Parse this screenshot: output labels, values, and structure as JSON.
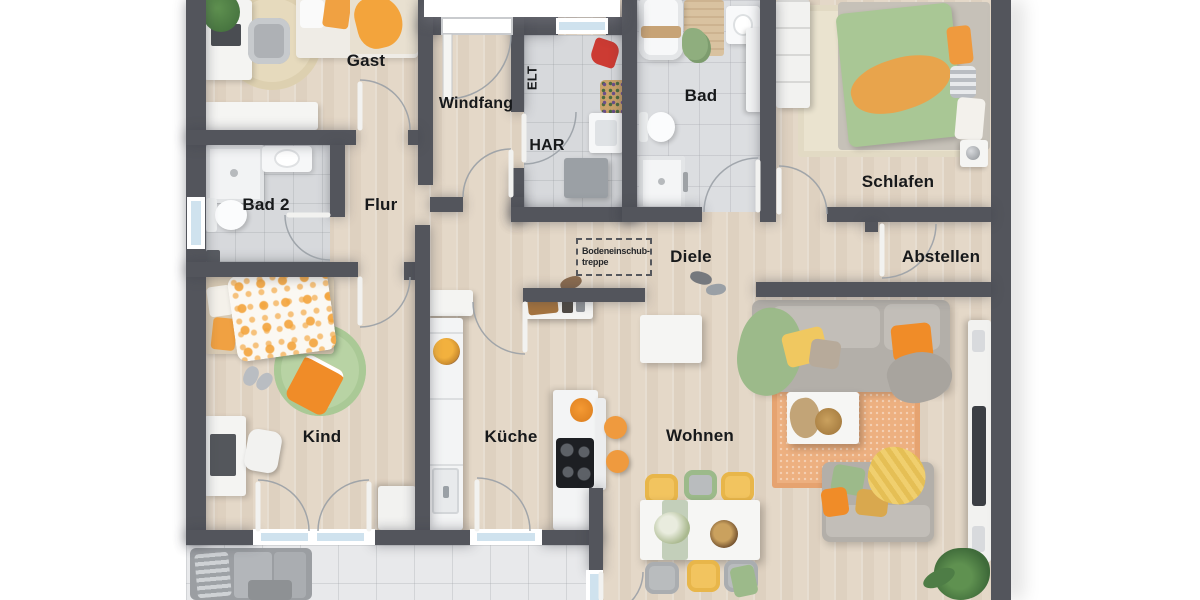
{
  "rooms": {
    "gast": "Gast",
    "windfang": "Windfang",
    "elt": "ELT",
    "har": "HAR",
    "bad": "Bad",
    "schlafen": "Schlafen",
    "bad2": "Bad 2",
    "flur": "Flur",
    "diele": "Diele",
    "abstellen": "Abstellen",
    "kind": "Kind",
    "kueche": "Küche",
    "wohnen": "Wohnen"
  },
  "attic_hatch": {
    "line1": "Bodeneinschub-",
    "line2": "treppe"
  },
  "colors": {
    "wall": "#53555c",
    "wood_floor": "#e4d8c8",
    "tile_floor": "#d7d9dc",
    "terrace_floor": "#e8e9eb",
    "window_glass": "#cfe2ee",
    "accent_orange": "#f0a142",
    "accent_green": "#a9c795",
    "accent_yellow": "#f2c45f",
    "sofa_gray": "#b3afa9",
    "rug_orange": "#edb080"
  }
}
